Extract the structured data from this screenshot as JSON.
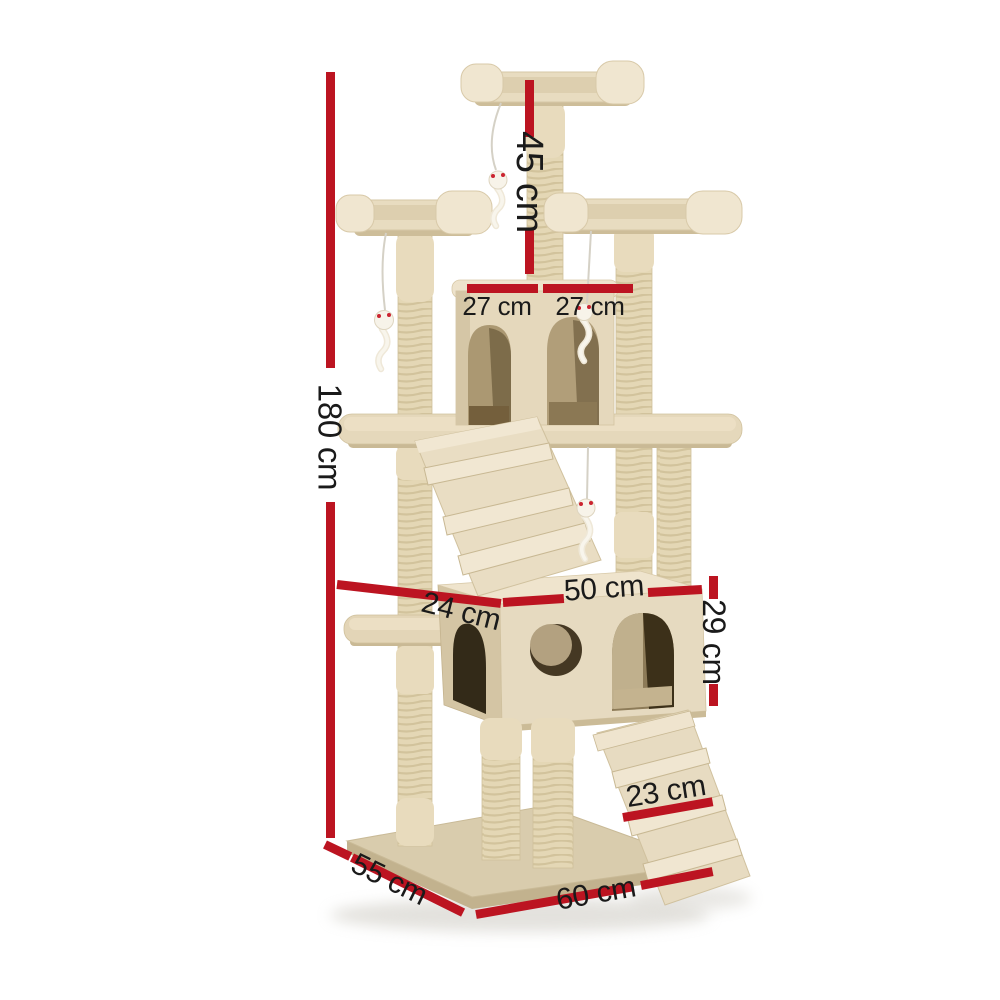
{
  "figure": {
    "description": "Beige plush cat tree scratching post tower with red dimension lines on white background"
  },
  "dimensions": {
    "total_height": "180 cm",
    "top_post_height": "45 cm",
    "condo_width_left": "27 cm",
    "condo_width_right": "27 cm",
    "house_depth": "24 cm",
    "house_width": "50 cm",
    "house_height": "29 cm",
    "ramp_width": "23 cm",
    "base_depth": "55 cm",
    "base_width": "60 cm"
  },
  "colors": {
    "dimension_line": "#bc1421",
    "label_text": "#1a1a1a",
    "background": "#ffffff",
    "plush_beige": "#e8dcc0",
    "sisal_rope": "#e4d7b5",
    "opening_shadow": "#332a18"
  }
}
